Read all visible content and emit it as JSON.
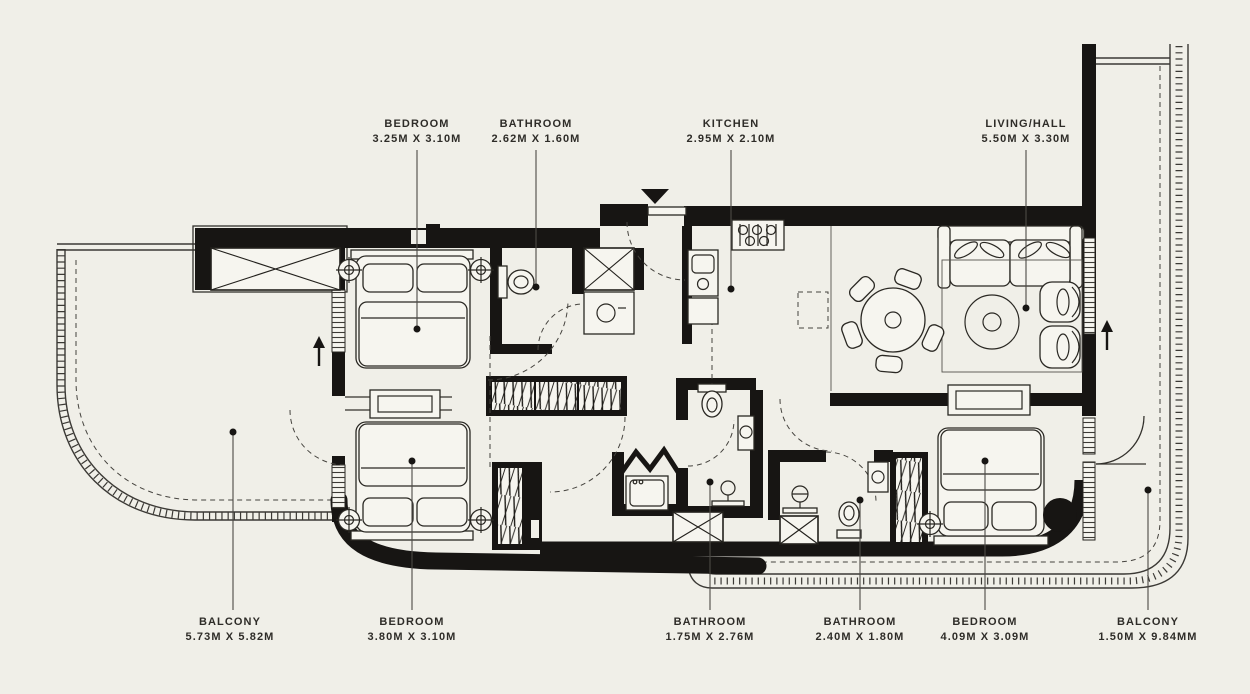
{
  "meta": {
    "background_color": "#f0efe8",
    "ink_color": "#171513",
    "drawing_type": "apartment floor plan"
  },
  "floor_plan": {
    "top_labels": [
      {
        "name": "BEDROOM",
        "dims": "3.25M X 3.10M"
      },
      {
        "name": "BATHROOM",
        "dims": "2.62M X 1.60M"
      },
      {
        "name": "KITCHEN",
        "dims": "2.95M X 2.10M"
      },
      {
        "name": "LIVING/HALL",
        "dims": "5.50M X 3.30M"
      }
    ],
    "bottom_labels": [
      {
        "name": "BALCONY",
        "dims": "5.73M X 5.82M"
      },
      {
        "name": "BEDROOM",
        "dims": "3.80M X 3.10M"
      },
      {
        "name": "BATHROOM",
        "dims": "1.75M X 2.76M"
      },
      {
        "name": "BATHROOM",
        "dims": "2.40M X 1.80M"
      },
      {
        "name": "BEDROOM",
        "dims": "4.09M X 3.09M"
      },
      {
        "name": "BALCONY",
        "dims": "1.50M X 9.84MM"
      }
    ]
  }
}
